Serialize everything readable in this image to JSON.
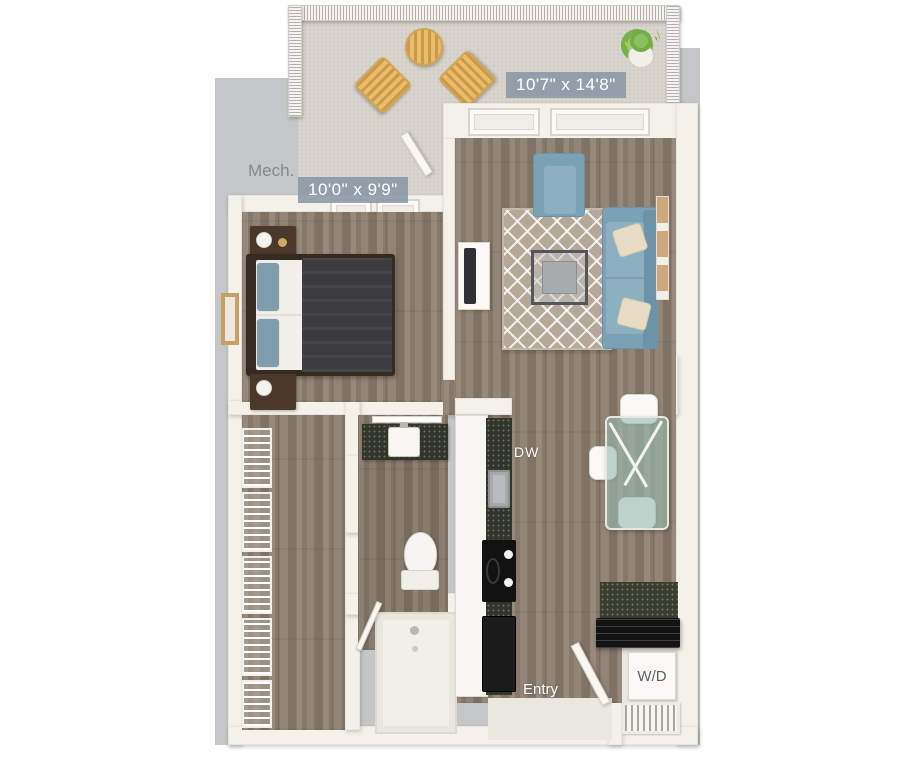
{
  "floorplan": {
    "type": "apartment-unit-3d-top-view-floor-plan",
    "labels": {
      "living_room_dimensions": "10'7\" x 14'8\"",
      "bedroom_dimensions": "10'0\" x 9'9\"",
      "mechanical_room": "Mech.",
      "dishwasher": "DW",
      "entry": "Entry",
      "washer_dryer": "W/D"
    },
    "colors": {
      "background": "#ffffff",
      "exterior_mat": "#c5c6c7",
      "wall": "#f3f1ea",
      "wood_floor": "#8e8071",
      "balcony_floor": "#d4d0c9",
      "dimension_label_bg": "#8897a4",
      "dimension_label_text": "#ffffff",
      "furniture_blue": "#7ba1b5",
      "rug": "#b4a898",
      "outdoor_wood": "#e0b162",
      "counter_dark_speckle": "#31352a",
      "appliance_black": "#1a1a1a",
      "plant_green": "#8cc05e"
    }
  }
}
